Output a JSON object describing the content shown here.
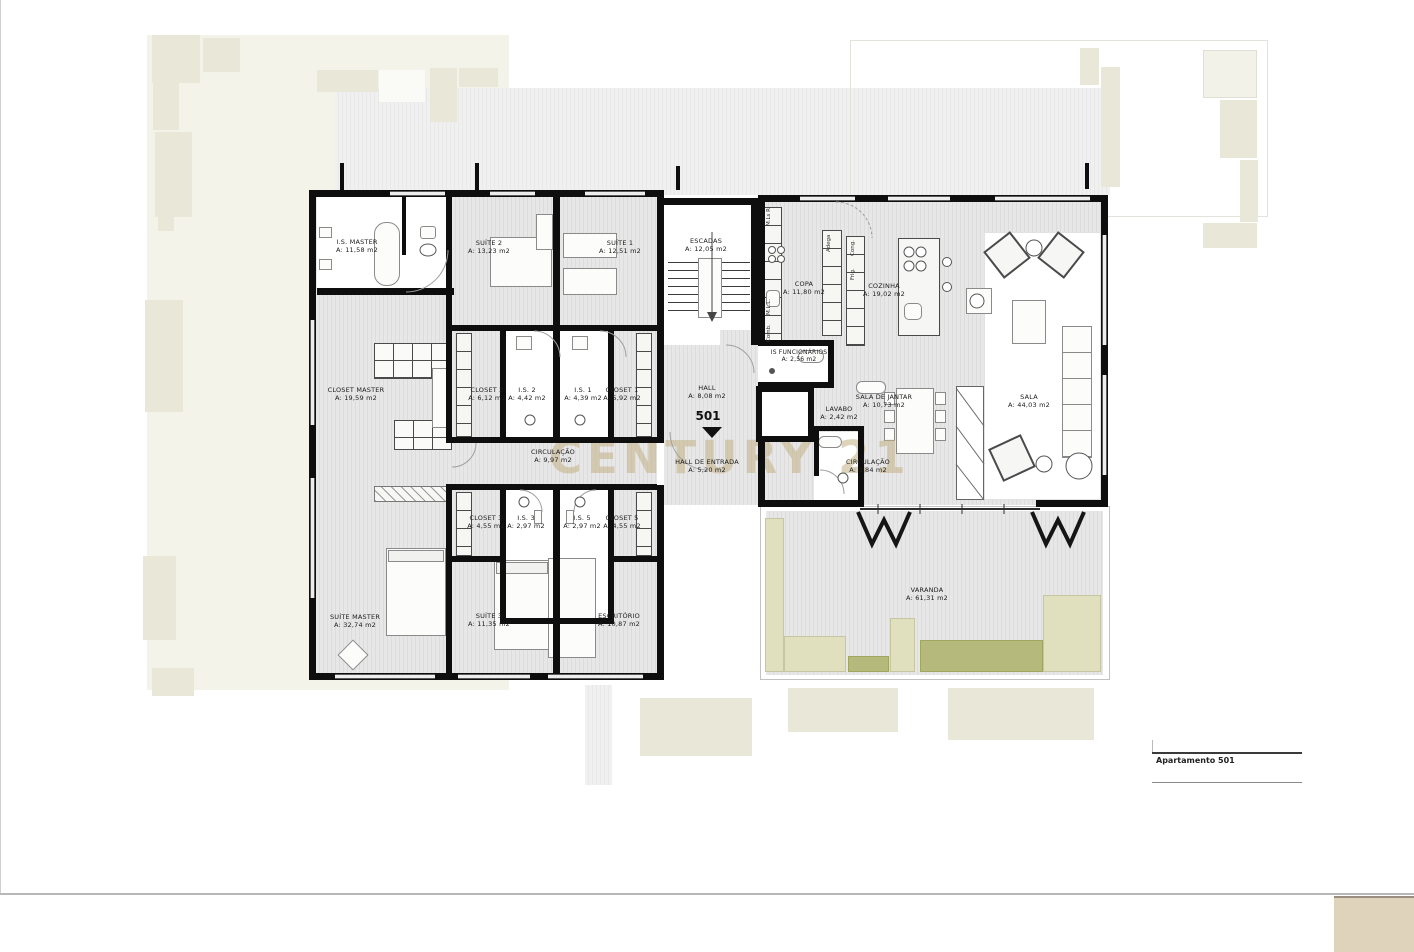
{
  "page": {
    "title_block": "Apartamento 501",
    "watermark": "CENTURY 21",
    "unit_number": "501"
  },
  "rooms": [
    {
      "name": "I.S. MASTER",
      "area": "A: 11,58 m2"
    },
    {
      "name": "SUÍTE 2",
      "area": "A: 13,23 m2"
    },
    {
      "name": "SUÍTE 1",
      "area": "A: 12,51 m2"
    },
    {
      "name": "ESCADAS",
      "area": "A: 12,05 m2"
    },
    {
      "name": "COPA",
      "area": "A: 11,80 m2"
    },
    {
      "name": "COZINHA",
      "area": "A: 19,02 m2"
    },
    {
      "name": "IS FUNCIONÁRIOS",
      "area": "A: 2,56 m2"
    },
    {
      "name": "CLOSET MASTER",
      "area": "A: 19,59 m2"
    },
    {
      "name": "CLOSET 2",
      "area": "A: 6,12 m2"
    },
    {
      "name": "I.S. 2",
      "area": "A: 4,42 m2"
    },
    {
      "name": "I.S. 1",
      "area": "A: 4,39 m2"
    },
    {
      "name": "CLOSET 1",
      "area": "A: 5,92 m2"
    },
    {
      "name": "HALL",
      "area": "A: 8,08 m2"
    },
    {
      "name": "LAVABO",
      "area": "A: 2,42 m2"
    },
    {
      "name": "SALA DE JANTAR",
      "area": "A: 10,73 m2"
    },
    {
      "name": "SALA",
      "area": "A: 44,03 m2"
    },
    {
      "name": "CIRCULAÇÃO",
      "area": "A: 9,97 m2"
    },
    {
      "name": "HALL DE ENTRADA",
      "area": "A: 5,20 m2"
    },
    {
      "name": "CIRCULAÇÃO",
      "area": "A: 9,84 m2"
    },
    {
      "name": "CLOSET 3",
      "area": "A: 4,55 m2"
    },
    {
      "name": "I.S. 3",
      "area": "A: 2,97 m2"
    },
    {
      "name": "I.S. 5",
      "area": "A: 2,97 m2"
    },
    {
      "name": "CLOSET 5",
      "area": "A: 4,55 m2"
    },
    {
      "name": "SUÍTE MASTER",
      "area": "A: 32,74 m2"
    },
    {
      "name": "SUÍTE 3",
      "area": "A: 11,35 m2"
    },
    {
      "name": "ESCRITÓRIO",
      "area": "A: 10,87 m2"
    },
    {
      "name": "VARANDA",
      "area": "A: 61,31 m2"
    }
  ],
  "cabinets": {
    "mlsr": "M.Ls R",
    "mll": "M.L.L.",
    "comb": "Comb.",
    "adega": "Adega",
    "cong": "Cong.",
    "frig": "Frig."
  },
  "colors": {
    "wall": "#0e0e0e",
    "floor_hatch": "#e3e3e4",
    "watermark": "#c3b184",
    "planter_olive": "#b6b97c",
    "planter_pale": "#e0e0bf",
    "background_beige": "#e9e7d7",
    "corner_tan": "#e0d3bc"
  }
}
